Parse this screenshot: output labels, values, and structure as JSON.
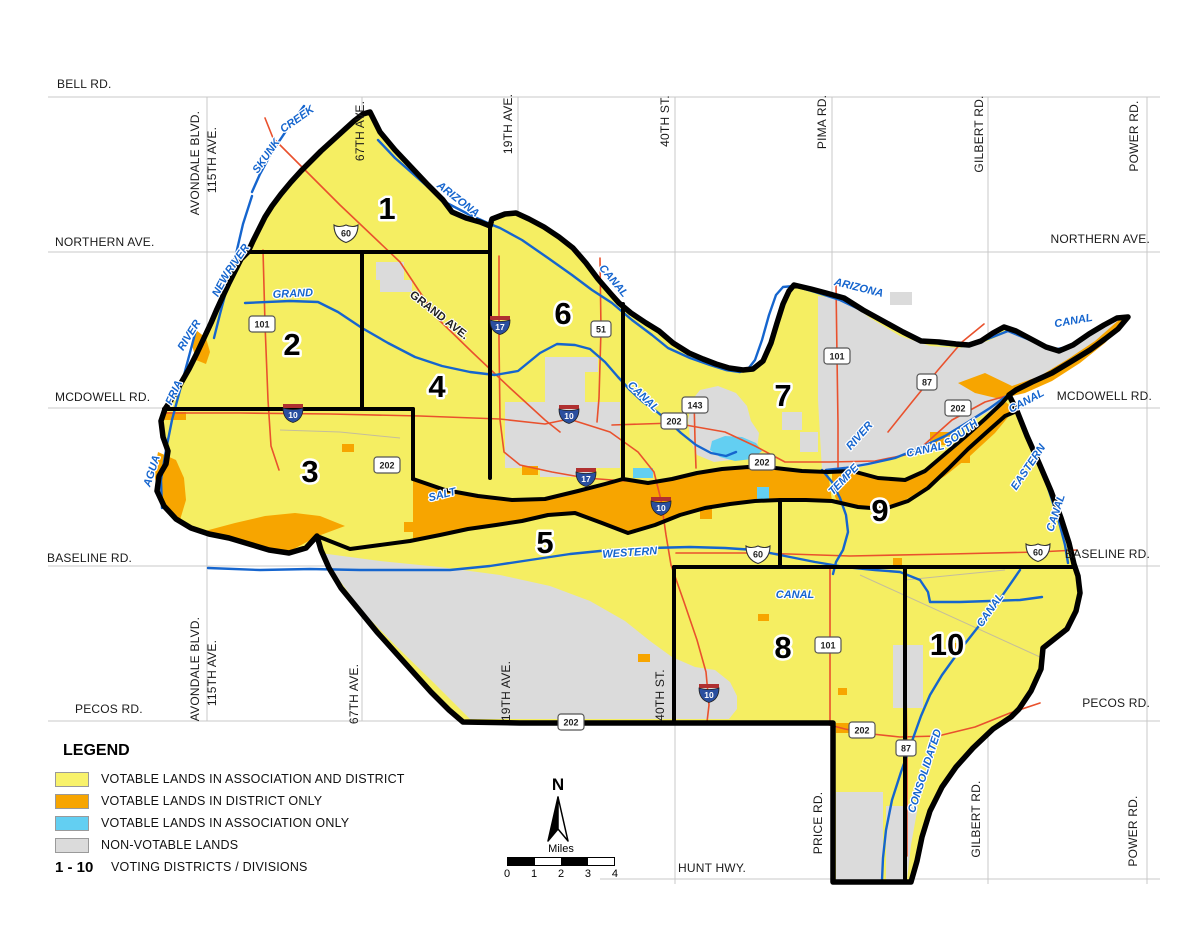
{
  "legend": {
    "heading": "LEGEND",
    "items": [
      {
        "name": "votable-association-and-district",
        "label": "VOTABLE LANDS IN ASSOCIATION AND DISTRICT",
        "color": "#F8F26B"
      },
      {
        "name": "votable-district-only",
        "label": "VOTABLE LANDS IN DISTRICT ONLY",
        "color": "#F7A500"
      },
      {
        "name": "votable-association-only",
        "label": "VOTABLE LANDS IN ASSOCIATION ONLY",
        "color": "#63CFF2"
      },
      {
        "name": "non-votable",
        "label": "NON-VOTABLE LANDS",
        "color": "#DBDBDB"
      }
    ],
    "districts_range": "1 - 10",
    "districts_label": "VOTING DISTRICTS / DIVISIONS"
  },
  "north_arrow": {
    "label": "N"
  },
  "scale_bar": {
    "unit_label": "Miles",
    "ticks": [
      "0",
      "1",
      "2",
      "3",
      "4"
    ]
  },
  "map": {
    "colors": {
      "votable_both": "#F5EE62",
      "district_only": "#F7A500",
      "association_only": "#63CFF2",
      "non_votable": "#DBDBDB",
      "canal_blue": "#1565CE",
      "highway_red": "#E9512D",
      "boundary_black": "#000000"
    },
    "district_labels": [
      {
        "id": "1",
        "x": 387,
        "y": 219
      },
      {
        "id": "2",
        "x": 292,
        "y": 355
      },
      {
        "id": "3",
        "x": 310,
        "y": 482
      },
      {
        "id": "4",
        "x": 437,
        "y": 397
      },
      {
        "id": "5",
        "x": 545,
        "y": 553
      },
      {
        "id": "6",
        "x": 563,
        "y": 324
      },
      {
        "id": "7",
        "x": 783,
        "y": 406
      },
      {
        "id": "8",
        "x": 783,
        "y": 658
      },
      {
        "id": "9",
        "x": 880,
        "y": 521
      },
      {
        "id": "10",
        "x": 947,
        "y": 655
      }
    ],
    "edge_labels": [
      {
        "text": "BELL RD.",
        "x": 57,
        "y": 88,
        "anchor": "start"
      },
      {
        "text": "NORTHERN AVE.",
        "x": 55,
        "y": 246,
        "anchor": "start"
      },
      {
        "text": "NORTHERN AVE.",
        "x": 1150,
        "y": 243,
        "anchor": "end"
      },
      {
        "text": "MCDOWELL RD.",
        "x": 55,
        "y": 401,
        "anchor": "start"
      },
      {
        "text": "MCDOWELL RD.",
        "x": 1152,
        "y": 400,
        "anchor": "end"
      },
      {
        "text": "BASELINE RD.",
        "x": 47,
        "y": 562,
        "anchor": "start"
      },
      {
        "text": "BASELINE RD.",
        "x": 1150,
        "y": 558,
        "anchor": "end"
      },
      {
        "text": "PECOS RD.",
        "x": 75,
        "y": 713,
        "anchor": "start"
      },
      {
        "text": "PECOS RD.",
        "x": 1150,
        "y": 707,
        "anchor": "end"
      },
      {
        "text": "HUNT HWY.",
        "x": 678,
        "y": 872,
        "anchor": "start"
      }
    ],
    "street_labels": [
      {
        "text": "AVONDALE BLVD.",
        "x": 199,
        "y": 163
      },
      {
        "text": "115TH AVE.",
        "x": 216,
        "y": 160
      },
      {
        "text": "67TH AVE.",
        "x": 364,
        "y": 131
      },
      {
        "text": "19TH AVE.",
        "x": 512,
        "y": 124
      },
      {
        "text": "40TH ST.",
        "x": 669,
        "y": 121
      },
      {
        "text": "PIMA RD.",
        "x": 826,
        "y": 122
      },
      {
        "text": "GILBERT RD.",
        "x": 983,
        "y": 134
      },
      {
        "text": "POWER RD.",
        "x": 1138,
        "y": 136
      },
      {
        "text": "AVONDALE BLVD.",
        "x": 199,
        "y": 669
      },
      {
        "text": "115TH AVE.",
        "x": 216,
        "y": 673
      },
      {
        "text": "67TH AVE.",
        "x": 358,
        "y": 694
      },
      {
        "text": "19TH AVE.",
        "x": 510,
        "y": 691
      },
      {
        "text": "40TH ST.",
        "x": 664,
        "y": 695
      },
      {
        "text": "PRICE RD.",
        "x": 822,
        "y": 823
      },
      {
        "text": "GILBERT RD.",
        "x": 980,
        "y": 819
      },
      {
        "text": "POWER RD.",
        "x": 1137,
        "y": 831
      }
    ],
    "water_labels": [
      {
        "text": "SKUNK",
        "x": 269,
        "y": 158,
        "rot": -55
      },
      {
        "text": "CREEK",
        "x": 299,
        "y": 122,
        "rot": -35
      },
      {
        "text": "ARIZONA",
        "x": 456,
        "y": 202,
        "rot": 38
      },
      {
        "text": "CANAL",
        "x": 611,
        "y": 283,
        "rot": 50
      },
      {
        "text": "ARIZONA",
        "x": 858,
        "y": 291,
        "rot": 14
      },
      {
        "text": "CANAL",
        "x": 1074,
        "y": 324,
        "rot": -10
      },
      {
        "text": "NEW",
        "x": 224,
        "y": 286,
        "rot": -62
      },
      {
        "text": "RIVER",
        "x": 240,
        "y": 261,
        "rot": -55
      },
      {
        "text": "RIVER",
        "x": 192,
        "y": 337,
        "rot": -58
      },
      {
        "text": "FRIA",
        "x": 177,
        "y": 394,
        "rot": -65
      },
      {
        "text": "AGUA",
        "x": 155,
        "y": 472,
        "rot": -72
      },
      {
        "text": "GRAND",
        "x": 293,
        "y": 297,
        "rot": -3
      },
      {
        "text": "CANAL",
        "x": 641,
        "y": 399,
        "rot": 44
      },
      {
        "text": "SALT",
        "x": 443,
        "y": 498,
        "rot": -14
      },
      {
        "text": "WESTERN",
        "x": 630,
        "y": 556,
        "rot": -4
      },
      {
        "text": "CANAL",
        "x": 795,
        "y": 598,
        "rot": 0
      },
      {
        "text": "TEMPE",
        "x": 846,
        "y": 482,
        "rot": -46
      },
      {
        "text": "RIVER",
        "x": 862,
        "y": 438,
        "rot": -48
      },
      {
        "text": "SOUTH",
        "x": 963,
        "y": 436,
        "rot": -36
      },
      {
        "text": "CANAL",
        "x": 926,
        "y": 453,
        "rot": -12
      },
      {
        "text": "CANAL",
        "x": 1028,
        "y": 404,
        "rot": -28
      },
      {
        "text": "EASTERN",
        "x": 1031,
        "y": 469,
        "rot": -56
      },
      {
        "text": "CANAL",
        "x": 1059,
        "y": 514,
        "rot": -72
      },
      {
        "text": "CONSOLIDATED",
        "x": 928,
        "y": 772,
        "rot": -72
      },
      {
        "text": "CANAL",
        "x": 993,
        "y": 612,
        "rot": -55
      }
    ],
    "other_labels": [
      {
        "text": "GRAND AVE.",
        "x": 437,
        "y": 318,
        "rot": 38
      }
    ],
    "shields": [
      {
        "num": "60",
        "type": "us",
        "x": 346,
        "y": 233
      },
      {
        "num": "60",
        "type": "us",
        "x": 758,
        "y": 554
      },
      {
        "num": "60",
        "type": "us",
        "x": 1038,
        "y": 552
      },
      {
        "num": "17",
        "type": "i",
        "x": 500,
        "y": 325
      },
      {
        "num": "17",
        "type": "i",
        "x": 586,
        "y": 477
      },
      {
        "num": "10",
        "type": "i",
        "x": 293,
        "y": 413
      },
      {
        "num": "10",
        "type": "i",
        "x": 569,
        "y": 414
      },
      {
        "num": "10",
        "type": "i",
        "x": 661,
        "y": 506
      },
      {
        "num": "10",
        "type": "i",
        "x": 709,
        "y": 693
      },
      {
        "num": "51",
        "type": "s",
        "x": 601,
        "y": 329
      },
      {
        "num": "143",
        "type": "s",
        "x": 695,
        "y": 405
      },
      {
        "num": "101",
        "type": "s",
        "x": 262,
        "y": 324
      },
      {
        "num": "101",
        "type": "s",
        "x": 837,
        "y": 356
      },
      {
        "num": "101",
        "type": "s",
        "x": 828,
        "y": 645
      },
      {
        "num": "202",
        "type": "s",
        "x": 387,
        "y": 465
      },
      {
        "num": "202",
        "type": "s",
        "x": 674,
        "y": 421
      },
      {
        "num": "202",
        "type": "s",
        "x": 762,
        "y": 462
      },
      {
        "num": "202",
        "type": "s",
        "x": 958,
        "y": 408
      },
      {
        "num": "202",
        "type": "s",
        "x": 571,
        "y": 722
      },
      {
        "num": "202",
        "type": "s",
        "x": 862,
        "y": 730
      },
      {
        "num": "87",
        "type": "s",
        "x": 927,
        "y": 382
      },
      {
        "num": "87",
        "type": "s",
        "x": 906,
        "y": 748
      }
    ]
  }
}
